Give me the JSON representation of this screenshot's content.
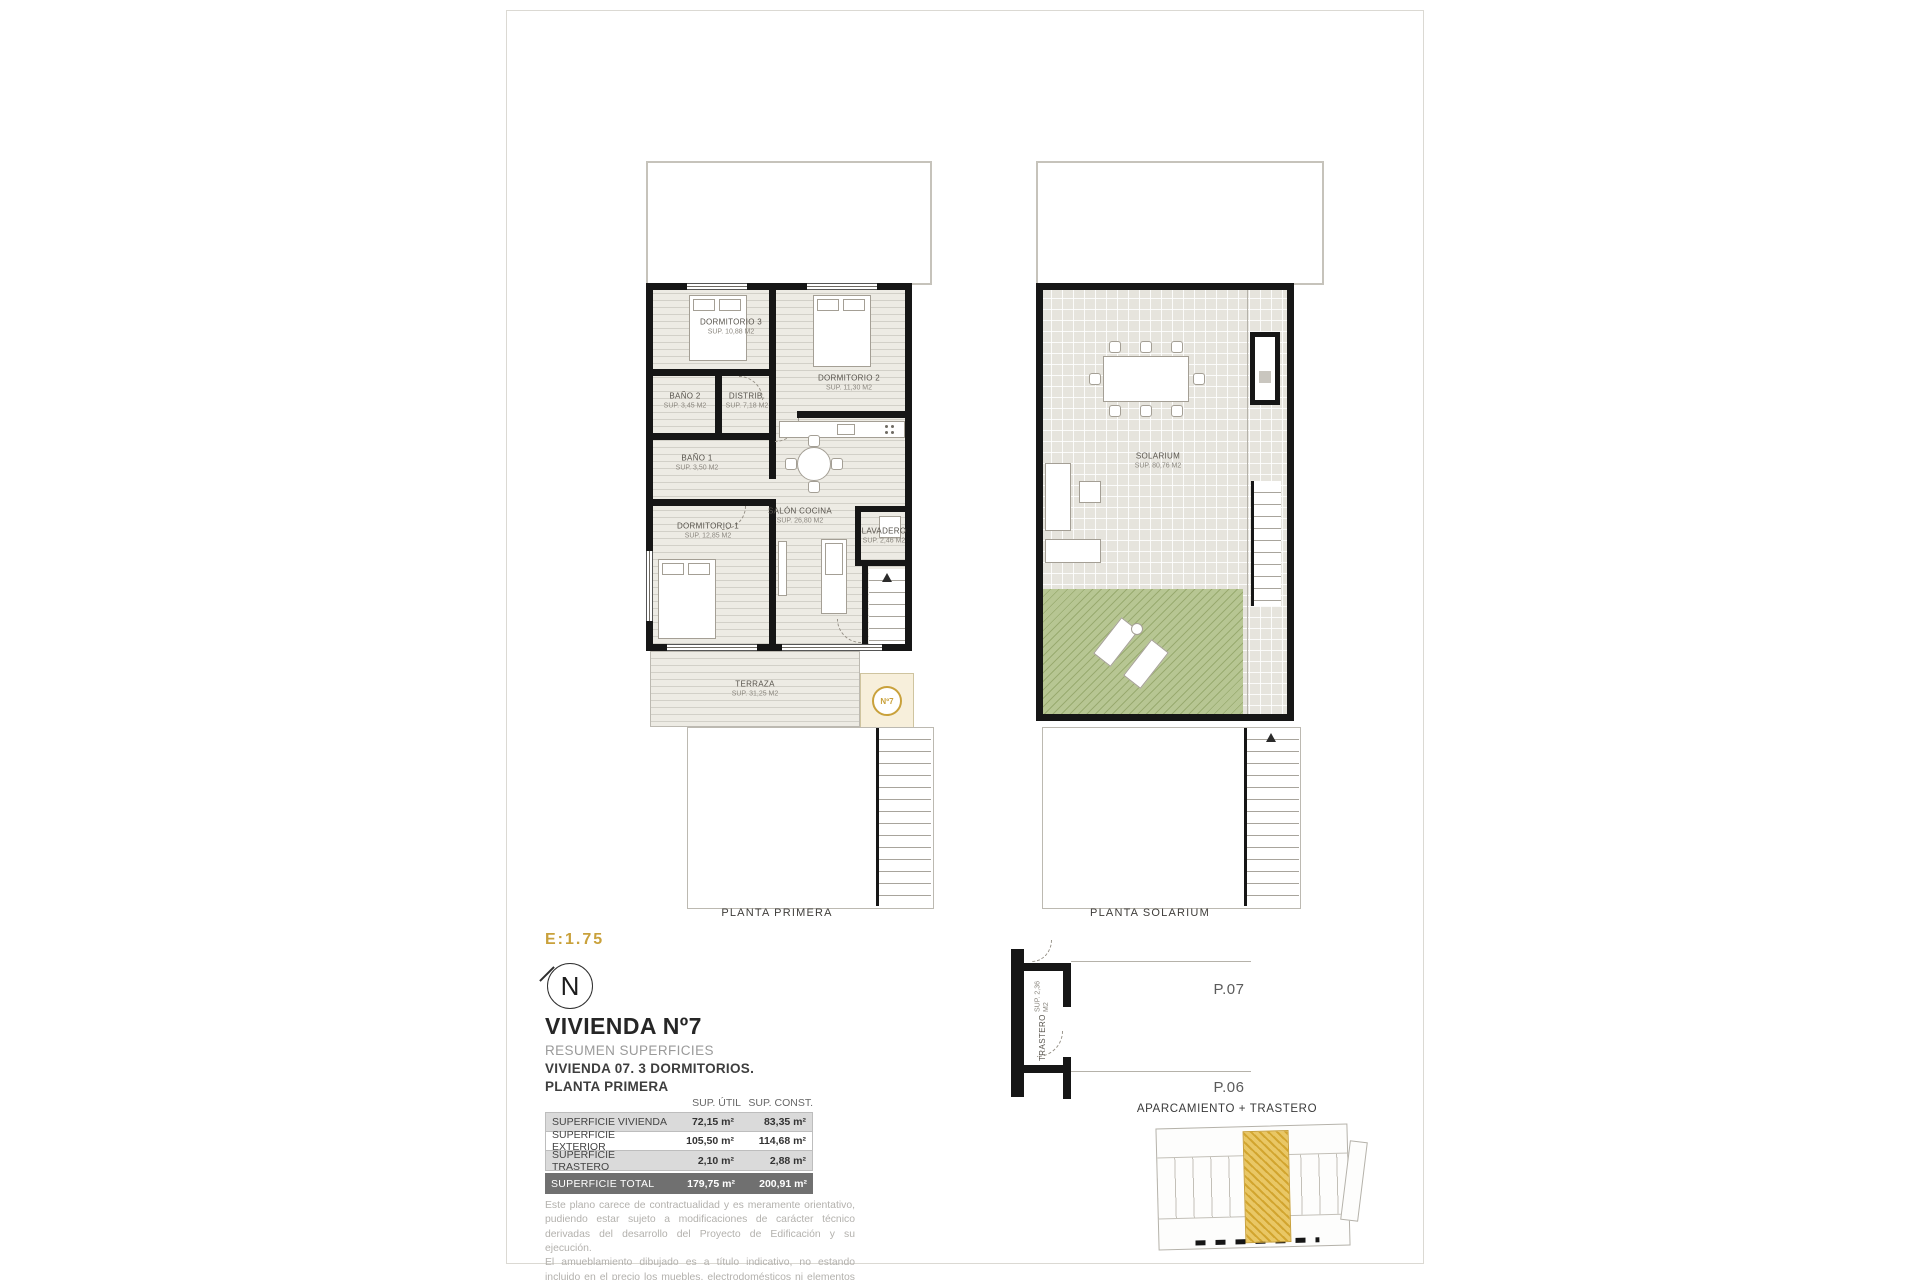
{
  "sheet": {
    "scale_label": "E:1.75",
    "north_label": "N"
  },
  "title_block": {
    "title": "VIVIENDA Nº7",
    "subtitle": "RESUMEN SUPERFICIES",
    "description": "VIVIENDA 07. 3 DORMITORIOS.",
    "floor": "PLANTA PRIMERA"
  },
  "surfaces_table": {
    "headers": [
      "SUP. ÚTIL",
      "SUP. CONST."
    ],
    "rows": [
      {
        "label": "SUPERFICIE VIVIENDA",
        "util": "72,15 m²",
        "const": "83,35 m²"
      },
      {
        "label": "SUPERFICIE EXTERIOR",
        "util": "105,50 m²",
        "const": "114,68 m²"
      },
      {
        "label": "SUPERFICIE TRASTERO",
        "util": "2,10 m²",
        "const": "2,88 m²"
      }
    ],
    "total": {
      "label": "SUPERFICIE TOTAL",
      "util": "179,75 m²",
      "const": "200,91 m²"
    }
  },
  "disclaimer": [
    "Este plano carece de contractualidad y es meramente orientativo, pudiendo estar sujeto a modificaciones de carácter técnico derivadas del desarrollo del Proyecto de Edificación y su ejecución.",
    "El amueblamiento dibujado es a título indicativo, no estando incluido en el precio los muebles, electrodomésticos ni elementos de decoración.",
    "Solo se incluye los elementos incluidos en la memoria del Proyecto visado."
  ],
  "plan_primera": {
    "caption": "PLANTA PRIMERA",
    "badge": "Nº7",
    "rooms": [
      {
        "name": "DORMITORIO 3",
        "area": "SUP. 10,88 M2"
      },
      {
        "name": "DORMITORIO 2",
        "area": "SUP. 11,30 M2"
      },
      {
        "name": "BAÑO 2",
        "area": "SUP. 3,45 M2"
      },
      {
        "name": "DISTRIB.",
        "area": "SUP. 7,18 M2"
      },
      {
        "name": "BAÑO 1",
        "area": "SUP. 3,50 M2"
      },
      {
        "name": "DORMITORIO 1",
        "area": "SUP. 12,85 M2"
      },
      {
        "name": "SALÓN COCINA",
        "area": "SUP. 26,80 M2"
      },
      {
        "name": "LAVADERO",
        "area": "SUP. 2,46 M2"
      },
      {
        "name": "TERRAZA",
        "area": "SUP. 31,25 M2"
      }
    ]
  },
  "plan_solarium": {
    "caption": "PLANTA SOLARIUM",
    "rooms": [
      {
        "name": "SOLARIUM",
        "area": "SUP. 80,76 M2"
      }
    ]
  },
  "detail": {
    "trastero_name": "TRASTERO",
    "trastero_area": "SUP. 2,36 M2",
    "plot_07": "P.07",
    "plot_06": "P.06",
    "caption": "APARCAMIENTO + TRASTERO"
  },
  "colors": {
    "accent_gold": "#c9a13b",
    "wall": "#161616",
    "grass": "#a9bb7e"
  }
}
